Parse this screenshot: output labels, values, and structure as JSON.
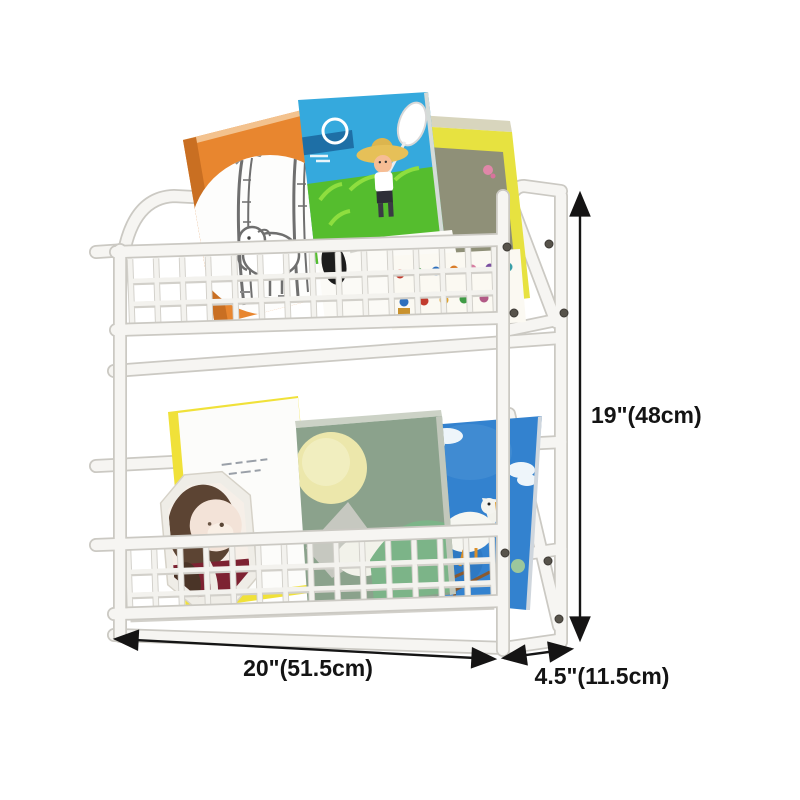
{
  "scene": {
    "description": "Two-tier white wall-mounted wire book rack holding children's picture books, annotated with product dimensions"
  },
  "frame": {
    "color": "#f6f5f2",
    "shadow_color": "#cbc9c3",
    "tiers": 2
  },
  "dimensions": {
    "arrow_color": "#151515",
    "height_label": "19\"(48cm)",
    "width_label": "20\"(51.5cm)",
    "depth_label": "4.5\"(11.5cm)"
  },
  "books": {
    "top_tier": [
      {
        "id": "orange-elephant-book",
        "cover_color": "#e8862f",
        "art": "white circle with pencil-sketch elephant between trees"
      },
      {
        "id": "yellow-picture-panel-book",
        "cover_color": "#e7e240",
        "art": "olive picture panel with tiny children and pink flower"
      },
      {
        "id": "blue-boy-net-book",
        "cover_color": "#35a9dd",
        "art": "boy in straw hat holding white net in green field"
      },
      {
        "id": "white-kids-book",
        "cover_color": "#fbf9f2",
        "art": "rows of tiny colorful children figures"
      }
    ],
    "bottom_tier": [
      {
        "id": "yellow-trim-white-book",
        "cover_color": "#fcfcfa",
        "trim_color": "#f0e139"
      },
      {
        "id": "blue-goose-book",
        "cover_color": "#3382cf",
        "art": "white goose flying among clouds"
      },
      {
        "id": "green-moon-book",
        "cover_color": "#8ba28c",
        "art": "pale moon, gray mountain and green hill"
      },
      {
        "id": "octagon-bear-frame",
        "frame_color": "#efede7",
        "art": "bear portrait with maroon outfit"
      }
    ]
  }
}
